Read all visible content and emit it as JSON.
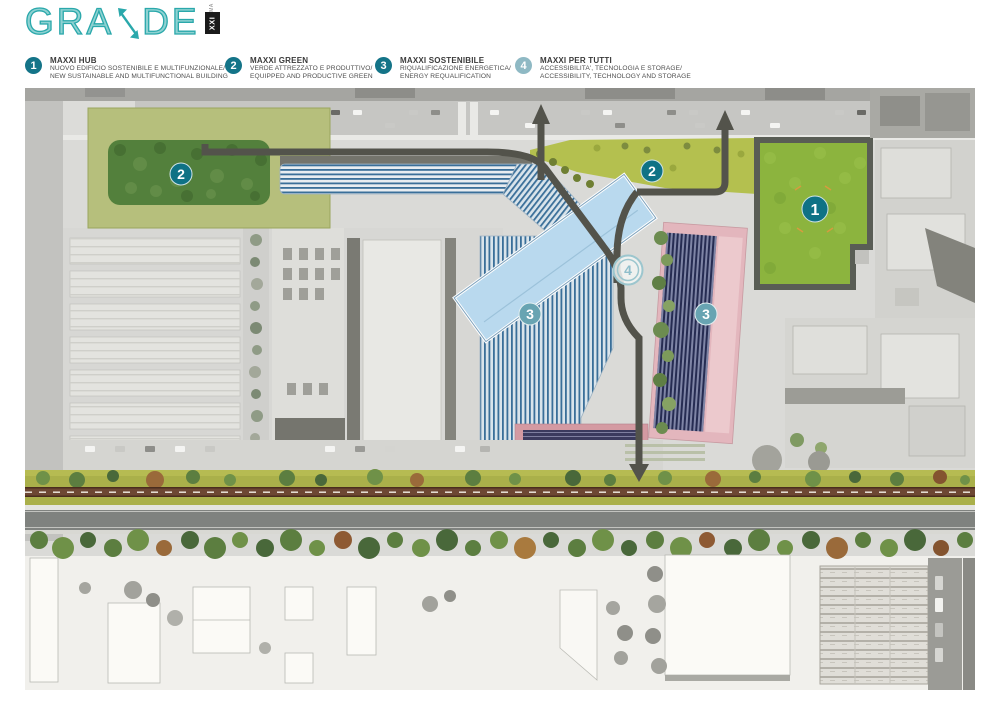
{
  "logo": {
    "part1": "GRA",
    "part2": "DE",
    "sub_small": "MA",
    "sub_boxed": "XXI",
    "color": "#2aa8ab"
  },
  "legend": {
    "items": [
      {
        "number": "1",
        "title": "MAXXI HUB",
        "line1": "NUOVO EDIFICIO SOSTENIBILE E MULTIFUNZIONALE/",
        "line2": "NEW SUSTAINABLE AND MULTIFUNCTIONAL BUILDING",
        "circle_color": "#147488"
      },
      {
        "number": "2",
        "title": "MAXXI GREEN",
        "line1": "VERDE ATTREZZATO E PRODUTTIVO/",
        "line2": "EQUIPPED AND PRODUCTIVE GREEN",
        "circle_color": "#147488"
      },
      {
        "number": "3",
        "title": "MAXXI SOSTENIBILE",
        "line1": "RIQUALIFICAZIONE ENERGETICA/",
        "line2": "ENERGY REQUALIFICATION",
        "circle_color": "#147488"
      },
      {
        "number": "4",
        "title": "MAXXI PER TUTTI",
        "line1": "ACCESSIBILITA', TECNOLOGIA E STORAGE/",
        "line2": "ACCESSIBILITY, TECHNOLOGY AND STORAGE",
        "circle_color": "#8fb9c4"
      }
    ]
  },
  "map": {
    "markers": [
      {
        "label": "1",
        "area": "maxxi-hub-green-field"
      },
      {
        "label": "2",
        "area": "maxxi-green-west-park"
      },
      {
        "label": "2",
        "area": "maxxi-green-central-strip"
      },
      {
        "label": "3",
        "area": "maxxi-sostenibile-museum-roof"
      },
      {
        "label": "3",
        "area": "maxxi-sostenibile-pv-building"
      },
      {
        "label": "4",
        "area": "maxxi-per-tutti-plaza"
      }
    ],
    "colors": {
      "marker_teal": "#0f7285",
      "marker_teal_light": "#68a4b2",
      "marker_ring": "#9cc6ce",
      "park_green_dark": "#53803c",
      "park_green_border": "#b6bf7c",
      "field_green": "#8cb43e",
      "strip_green": "#b4c04f",
      "museum_blue": "#3a6f99",
      "museum_light_blue": "#b9d9ee",
      "pv_navy": "#262c52",
      "pink_building": "#e3b6bd",
      "path_gray": "#53534b",
      "cycle_lane_brown": "#6d4733"
    }
  }
}
